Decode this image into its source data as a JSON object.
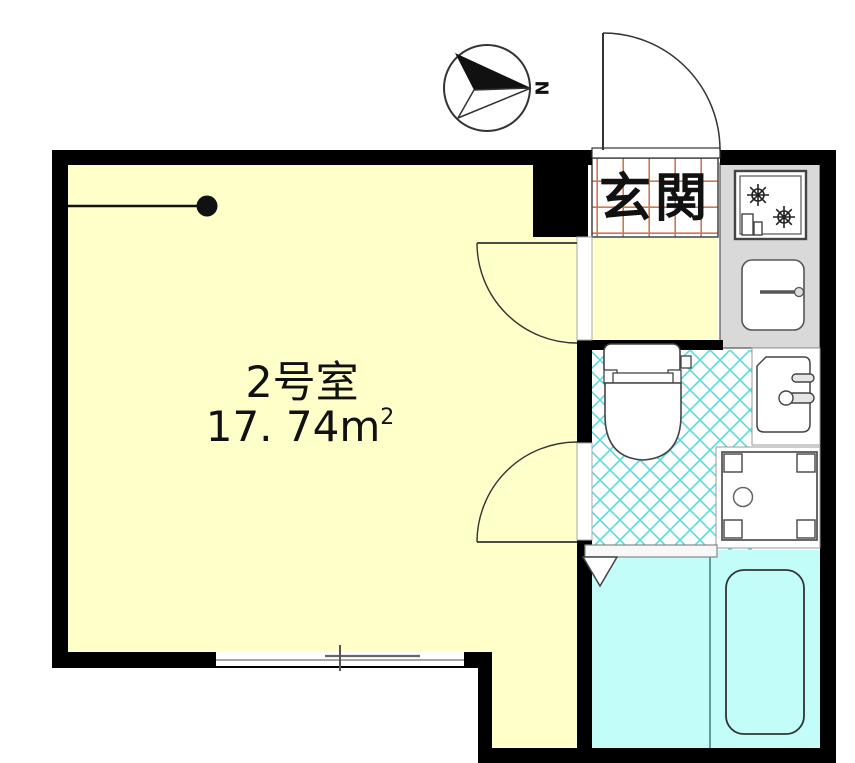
{
  "plan": {
    "room": {
      "label": "2号室",
      "area": "17. 74m",
      "area_sup": "2"
    },
    "entrance": {
      "label": "玄関"
    },
    "compass": {
      "north_label": "N"
    },
    "colors": {
      "wall": "#000000",
      "room_fill": "#FFFFC9",
      "entrance_fill": "#FFFFC9",
      "bath_fill": "#C2FDFA",
      "kitchen_fill": "#D9D9D9",
      "tile_line": "#CC7A50",
      "lattice_line": "#5ADCDC",
      "outline": "#333333",
      "fixture_fill": "#FFFFFF"
    }
  }
}
